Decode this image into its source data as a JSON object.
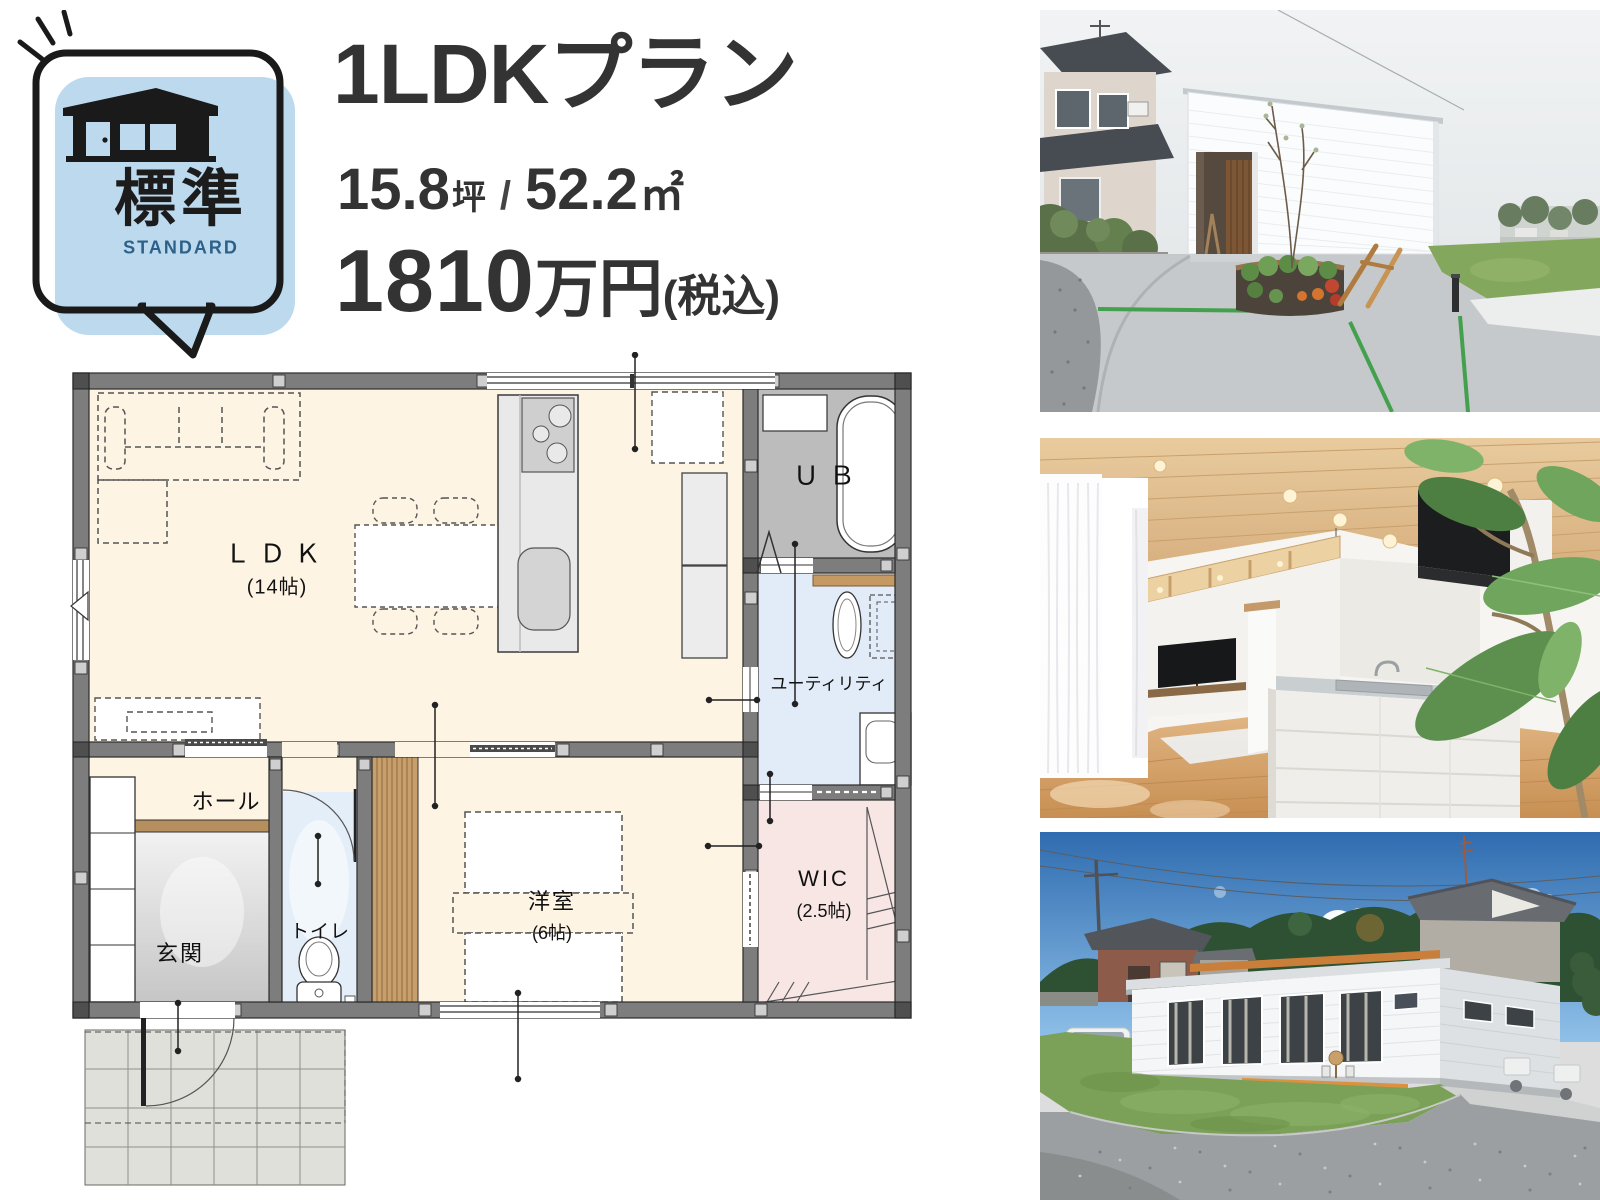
{
  "badge": {
    "kanji": "標準",
    "roman": "STANDARD"
  },
  "plan": {
    "title": "1LDKプラン",
    "area": {
      "tsubo_value": "15.8",
      "tsubo_unit": "坪",
      "divider": "/",
      "sqm_value": "52.2",
      "sqm_unit": "㎡"
    },
    "price": {
      "value": "1810",
      "unit": "万円",
      "tax_note": "(税込)"
    }
  },
  "floorplan": {
    "ldk": {
      "label": "ＬＤＫ",
      "size": "(14帖)"
    },
    "ub": {
      "label": "ＵＢ"
    },
    "utility": {
      "label": "ユーティリティ"
    },
    "hall": {
      "label": "ホール"
    },
    "entrance": {
      "label": "玄関"
    },
    "toilet": {
      "label": "トイレ"
    },
    "bedroom": {
      "label": "洋室",
      "size": "(6帖)"
    },
    "wic": {
      "label": "WIC",
      "size": "(2.5帖)"
    }
  },
  "colors": {
    "accent_blue": "#bcd9ee",
    "standard_text": "#2e6189",
    "title_text": "#333333",
    "floor_cream": "#fdf4e3",
    "floor_blue": "#e2ecf8",
    "floor_pink": "#f7e6e4",
    "wall_gray": "#7d7d7d",
    "wood": "#c69f6b"
  }
}
